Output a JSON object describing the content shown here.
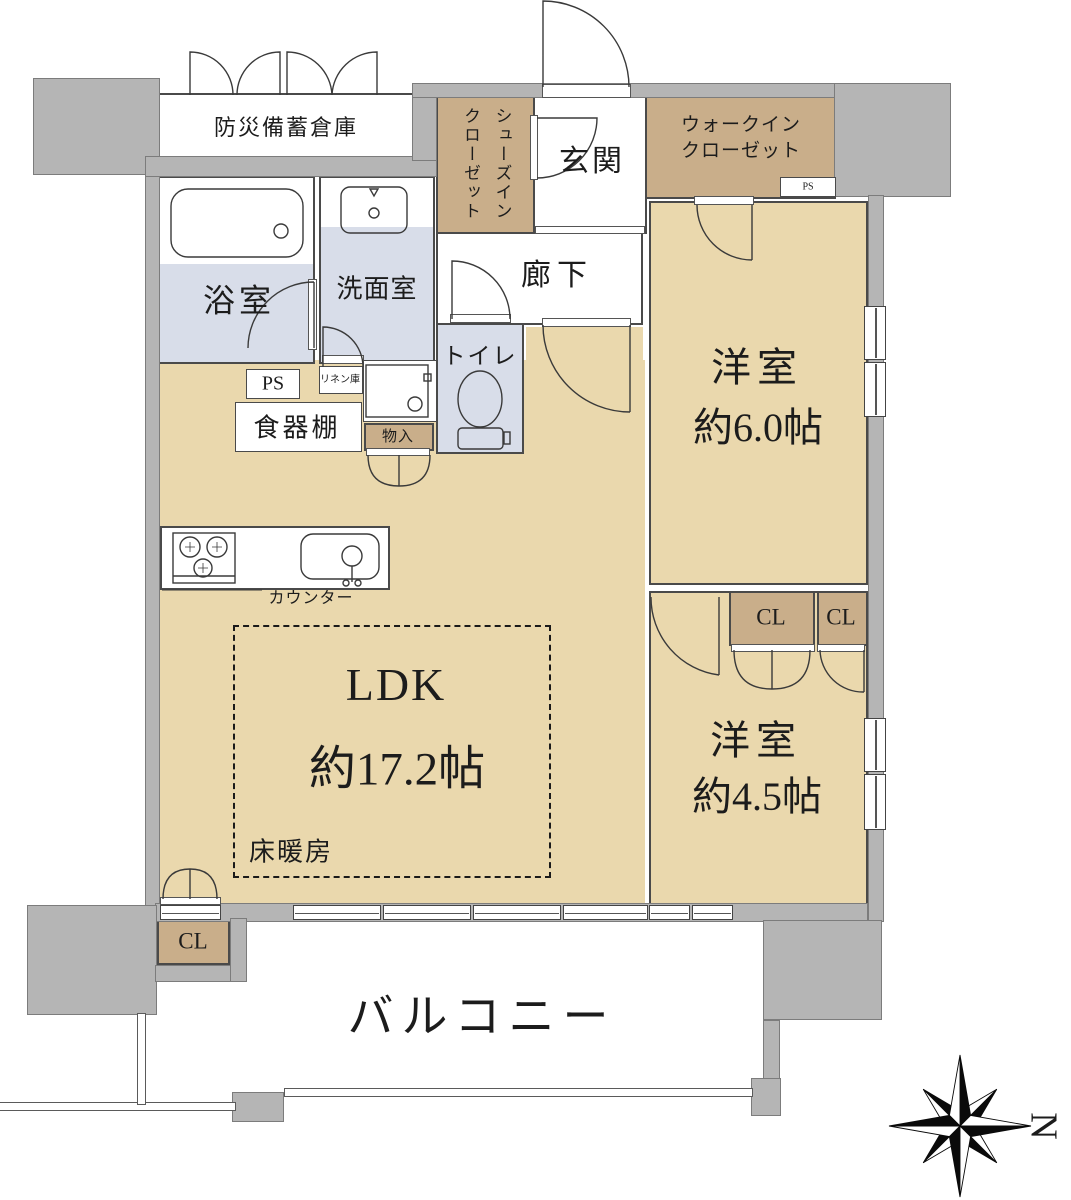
{
  "title": "マンション間取り図",
  "rooms": {
    "disaster_storage": "防災備蓄倉庫",
    "shoes_in_closet": "シューズイン\nクローゼット",
    "entrance": "玄関",
    "walk_in_closet": "ウォークイン\nクローゼット",
    "bathroom": "浴室",
    "washroom": "洗面室",
    "hallway": "廊下",
    "toilet": "トイレ",
    "bedroom1_name": "洋室",
    "bedroom1_size": "約6.0帖",
    "bedroom2_name": "洋室",
    "bedroom2_size": "約4.5帖",
    "ldk_name": "LDK",
    "ldk_size": "約17.2帖",
    "floor_heating": "床暖房",
    "balcony": "バルコニー"
  },
  "labels": {
    "ps": "PS",
    "linen": "リネン庫",
    "cupboard": "食器棚",
    "storage_small": "物入",
    "counter": "カウンター",
    "closet": "CL"
  },
  "compass": {
    "north": "N"
  },
  "colors": {
    "wall_fill": "#b5b5b5",
    "room_floor": "#ead8ad",
    "closet_floor": "#c9ae8a",
    "wet_floor": "#d8dde9",
    "line": "#3a3a3a"
  }
}
